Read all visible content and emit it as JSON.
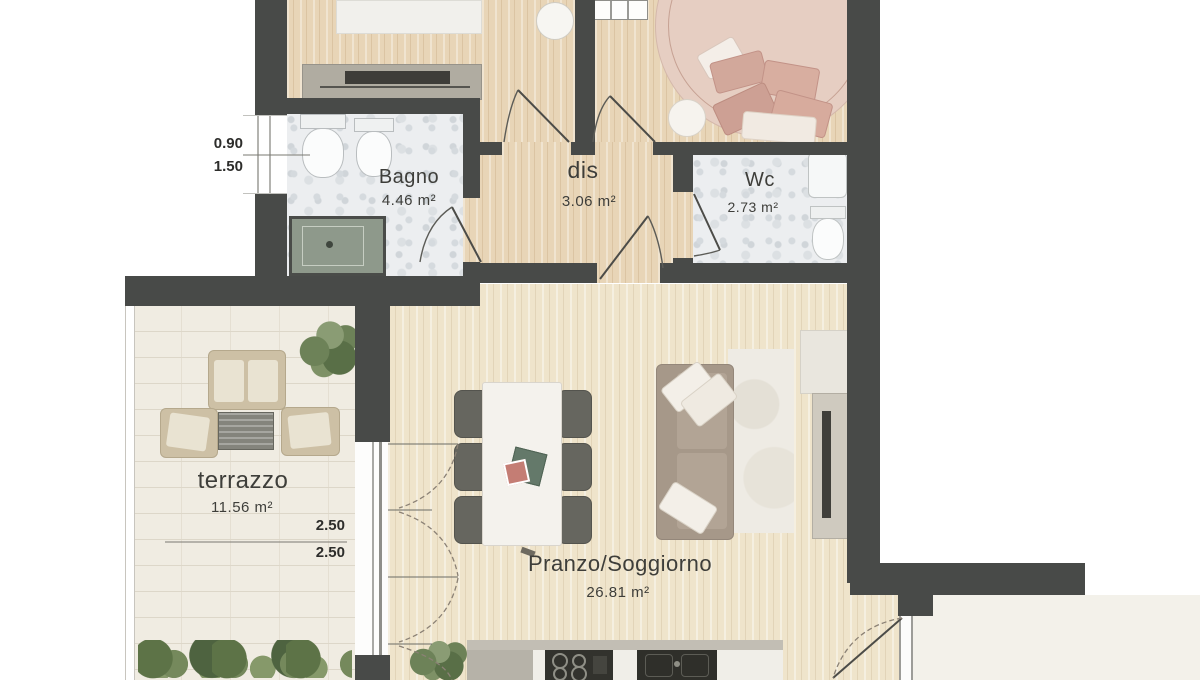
{
  "plan": {
    "rooms": [
      {
        "id": "bagno",
        "name": "Bagno",
        "area": "4.46 m²"
      },
      {
        "id": "dis",
        "name": "dis",
        "area": "3.06 m²"
      },
      {
        "id": "wc",
        "name": "Wc",
        "area": "2.73 m²"
      },
      {
        "id": "terrazzo",
        "name": "terrazzo",
        "area": "11.56 m²"
      },
      {
        "id": "pranzo-soggiorno",
        "name": "Pranzo/Soggiorno",
        "area": "26.81 m²"
      }
    ],
    "dimensions": [
      {
        "id": "bagno-window",
        "values": [
          "0.90",
          "1.50"
        ]
      },
      {
        "id": "terrace-door",
        "values": [
          "2.50",
          "2.50"
        ]
      }
    ],
    "colors": {
      "wall": "#484a48",
      "wood": "#e8d5b7",
      "wood_pale": "#efe4cb",
      "tile": "#eceef0",
      "stone": "#f0ece2",
      "bed": "#e6cec2",
      "pillow_pink": "#d2a89b",
      "sofa": "#a69889",
      "chair": "#66665f",
      "outdoor_frame": "#cdc0a5",
      "plant": "#6d8258",
      "counter": "#b6b2a8",
      "appliance": "#32322d"
    }
  }
}
